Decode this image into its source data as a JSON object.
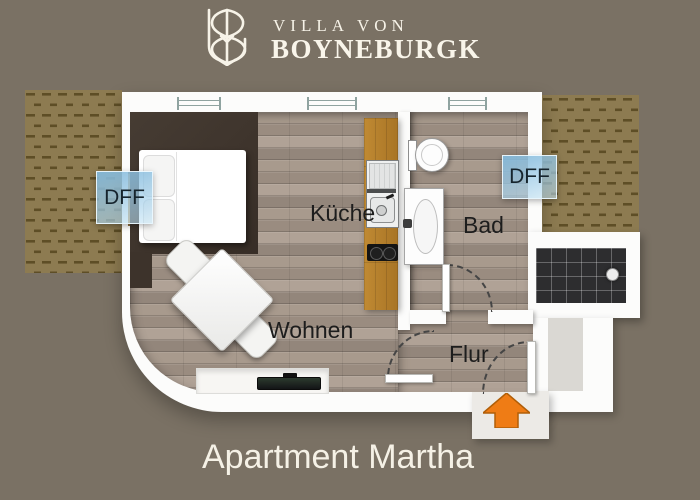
{
  "header": {
    "brand_line1": "VILLA VON",
    "brand_line2": "BOYNEBURGK"
  },
  "floorplan": {
    "labels": {
      "kueche": "Küche",
      "bad": "Bad",
      "wohnen": "Wohnen",
      "flur": "Flur"
    },
    "roof_windows": {
      "left_label": "DFF",
      "right_label": "DFF"
    },
    "fixtures": [
      "bed",
      "dining-table",
      "two-chairs",
      "sideboard-tv",
      "kitchen-sink",
      "cooktop",
      "toilet",
      "washbasin",
      "tiled-terrace",
      "floor-drain"
    ],
    "doors": [
      "bathroom-door",
      "living-to-hall-door",
      "entry-door"
    ],
    "entry_indicator": "orange-up-arrow"
  },
  "footer": {
    "title": "Apartment Martha"
  },
  "colors": {
    "background": "#7a7164",
    "roof_hatch": "#8d7b51",
    "roof_hatch_dash": "#5e4e26",
    "wall_white": "#fcfcfb",
    "wood_floor": "#a2958a",
    "bed_zone": "#3f352d",
    "counter_wood": "#b47e2c",
    "terrace_tile": "#2d2d2f",
    "dff_blue": "#9cc6e2",
    "entry_arrow_orange": "#ef7c15",
    "text_dark": "#1d1d1d",
    "text_cream": "#f5f1e6"
  }
}
